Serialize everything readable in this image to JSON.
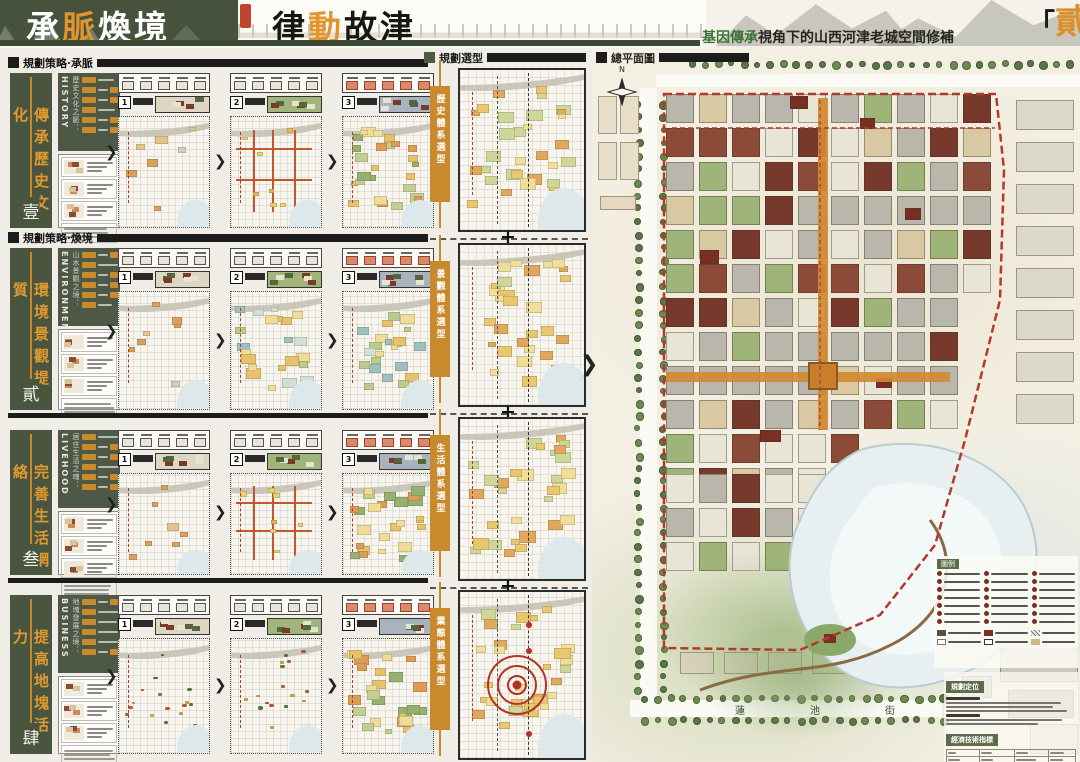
{
  "header": {
    "title_left": {
      "chars": [
        "承",
        "脈",
        "煥",
        "境"
      ],
      "accent_index": 1
    },
    "title_right": {
      "chars": [
        "律",
        "動",
        "故",
        "津"
      ],
      "accent_index": 1
    },
    "subtitle": {
      "accent": "基因傳承",
      "rest": "視角下的山西河津老城空間修補"
    },
    "volume": {
      "open": "「",
      "char": "貳",
      "close": "」"
    },
    "accent_color": "#e0952f",
    "green_color": "#3c7337"
  },
  "left_section": {
    "rows": [
      {
        "header": "規劃策略·承脈",
        "eng": "HISTORY",
        "theme": "歷史文化之脈：",
        "bar_label": "傳承歷史文化",
        "num": "壹",
        "steps": [
          "1",
          "2",
          "3"
        ]
      },
      {
        "header": "規劃策略·煥境",
        "eng": "ENVIRONMENT",
        "theme": "山水景觀之境：",
        "bar_label": "環境景觀提質",
        "num": "貳",
        "steps": [
          "1",
          "2",
          "3"
        ]
      },
      {
        "header": "",
        "eng": "LIVEHOOD",
        "theme": "居住生活之魂：",
        "bar_label": "完善生活網絡",
        "num": "叁",
        "steps": [
          "1",
          "2",
          "3"
        ]
      },
      {
        "header": "",
        "eng": "BUSINESS",
        "theme": "地塊發展之境：",
        "bar_label": "提高地塊活力",
        "num": "肆",
        "steps": [
          "1",
          "2",
          "3"
        ]
      }
    ]
  },
  "middle_section": {
    "header": "規劃選型",
    "tabs": [
      "歷史體系選型",
      "景觀體系選型",
      "生活體系選型",
      "業態體系選型"
    ],
    "plus": "+"
  },
  "masterplan": {
    "header": "總平面圖",
    "compass": "N",
    "street_bottom": [
      "蓮",
      "池",
      "街"
    ],
    "legend_title": "圖例",
    "notes_title": "規劃定位",
    "table_title": "經濟技術指標",
    "boundary_color": "#b23a2a"
  },
  "symbols": {
    "chevron": "❯",
    "dot": "·"
  }
}
